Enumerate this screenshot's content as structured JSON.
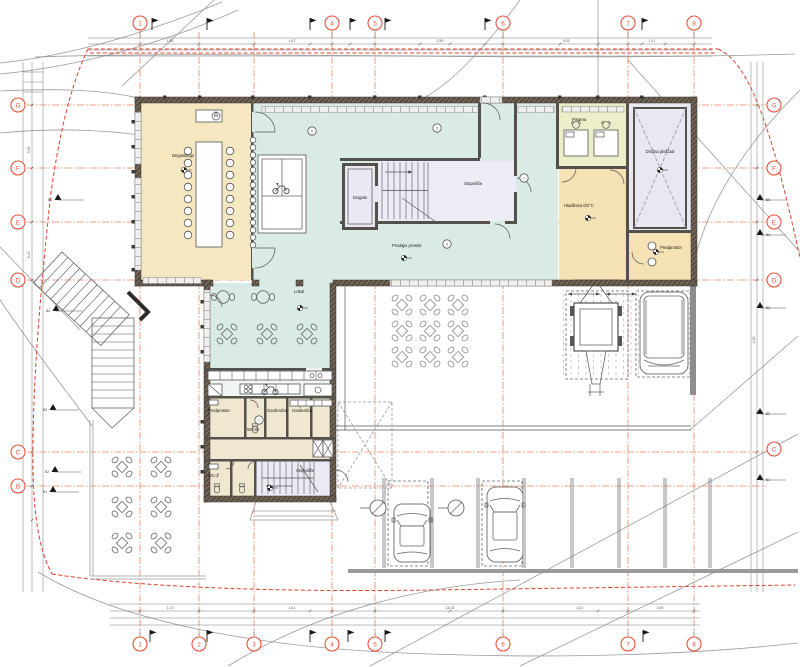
{
  "drawing": {
    "type": "architectural floor plan",
    "grid": {
      "top": [
        "1",
        "4",
        "5",
        "6",
        "7",
        "8"
      ],
      "bottom": [
        "1",
        "2",
        "3",
        "4",
        "5",
        "6",
        "7",
        "8"
      ],
      "left": [
        "G",
        "F",
        "E",
        "D",
        "C",
        "B"
      ],
      "right": [
        "G",
        "F",
        "E",
        "D",
        "C"
      ]
    },
    "rooms": {
      "degustacija": {
        "label": "Degustacija"
      },
      "prodajni": {
        "label": "Prodajni prostor"
      },
      "dvigalo": {
        "label": "Dvigalo"
      },
      "stopnisce": {
        "label": "Stopnišče"
      },
      "pisarna": {
        "label": "Pisarna"
      },
      "hladilnica": {
        "label": "Hladilnica 0/2°C"
      },
      "ploscad": {
        "label": "Dvižna ploščad"
      },
      "predprostor": {
        "label": "Predprostor"
      },
      "lokal": {
        "label": "Lokal"
      },
      "predprostor2": {
        "label": "Predprostor"
      },
      "wc_m": {
        "label": "WC-M"
      },
      "wc_z": {
        "label": "WC-Ž"
      },
      "garderoba": {
        "label": "Garderoba"
      },
      "garderoba2": {
        "label": "Garderoba"
      },
      "stopnisce2": {
        "label": "Stopnišče"
      }
    },
    "dimensions": {
      "top": [
        "1,50",
        "4,47",
        "2,50",
        "3,03",
        "1,17"
      ],
      "bottom": [
        "1,17",
        "4,41",
        "14,02",
        "4,47",
        "3,50"
      ],
      "left": [
        "3,50",
        "5,10"
      ],
      "right": [
        "4,25"
      ]
    },
    "door_tags": [
      "5",
      "3",
      "7",
      "6",
      "1"
    ],
    "benchmarks": {
      "left": [
        "B5",
        "B4",
        "B3",
        "B2",
        "B1"
      ],
      "right": [
        "B5",
        "B4",
        "B3",
        "B2",
        "B1"
      ]
    },
    "colors": {
      "grid_red": "#e8553a",
      "wall": "#54504b",
      "room_beige": "#f5e8c1",
      "room_cyan": "#daeae5",
      "room_yellow": "#eeedca",
      "room_lavender": "#e8e8f3",
      "line_gray": "#9b9b9b"
    }
  }
}
